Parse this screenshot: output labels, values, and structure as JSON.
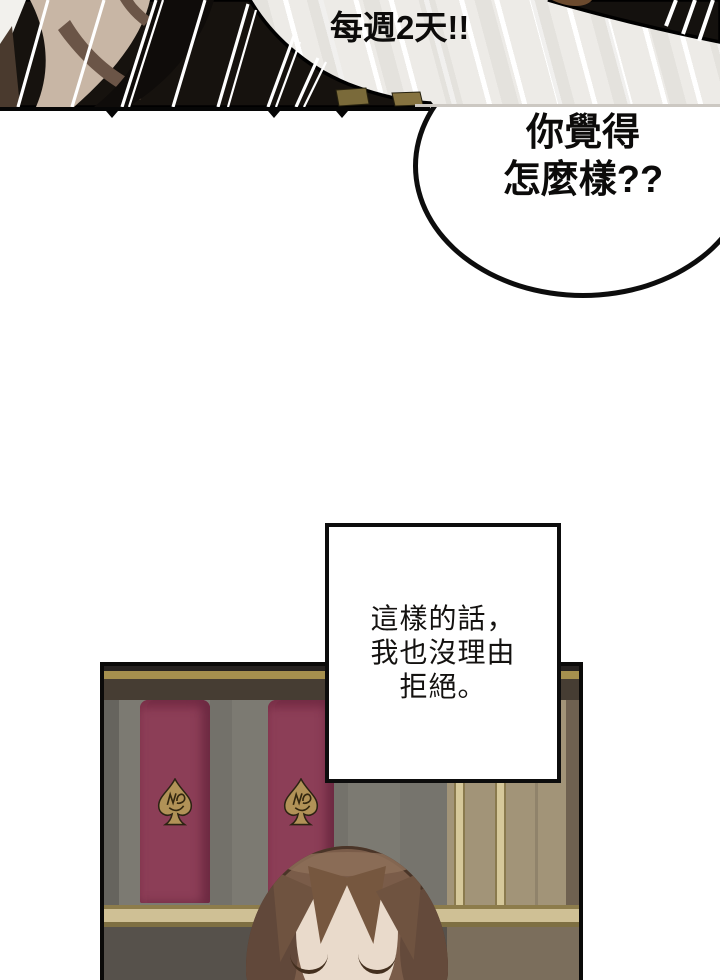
{
  "comic": {
    "top_panel": {
      "shout_text": "每週2天!!"
    },
    "bubble": {
      "line1": "你覺得",
      "line2": "怎麼樣??"
    },
    "caption_box": {
      "line1": "這樣的話，",
      "line2": "我也沒理由",
      "line3": "拒絕。"
    },
    "bottom_panel": {
      "emblem_icon": "spade-monogram"
    }
  },
  "colors": {
    "ink": "#0d0d0d",
    "stripe_bg": "#edebe7",
    "stripe_line": "#ffffff",
    "figure_skin": "#c8b6a5",
    "figure_shadow": "#6b5547",
    "red_panel": "#8c3e57",
    "grey_wall": "#7c7a72",
    "tan_wall": "#a29478",
    "gold_trim": "#cfc095",
    "valance_gold": "#a6904e",
    "spade_gold": "#b19257",
    "hair": "#7a5c49",
    "face_skin": "#e9dacb"
  }
}
